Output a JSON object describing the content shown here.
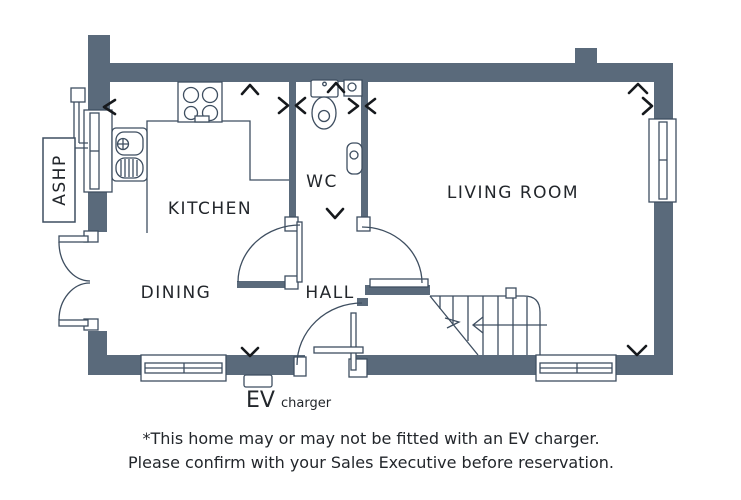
{
  "plan": {
    "rooms": {
      "kitchen": "KITCHEN",
      "dining": "DINING",
      "wc": "WC",
      "hall": "HALL",
      "living_room": "LIVING ROOM"
    },
    "equipment": {
      "ashp": "ASHP",
      "ev": "EV",
      "ev_suffix": "charger"
    },
    "colors": {
      "wall": "#5a6a7b",
      "line": "#3e4e60",
      "text": "#22262b",
      "chevron": "#16191d"
    }
  },
  "disclaimer": {
    "line1": "*This home may or may not be fitted with an EV charger.",
    "line2": "Please confirm with your Sales Executive before reservation."
  }
}
